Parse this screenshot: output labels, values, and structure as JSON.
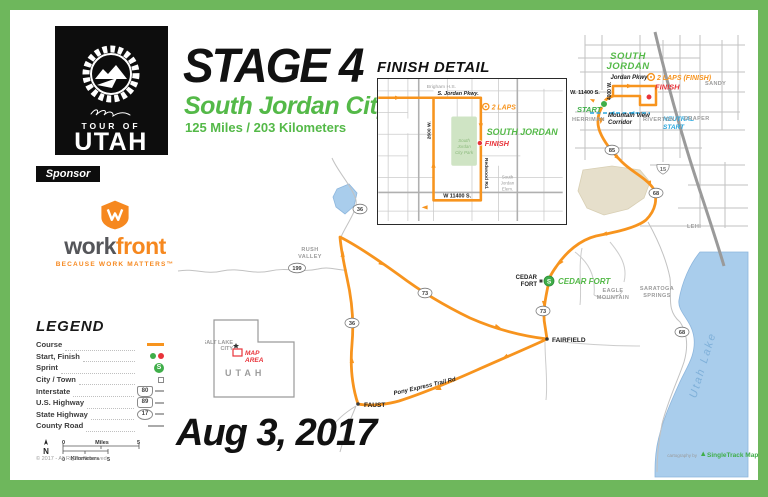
{
  "colors": {
    "frame_green": "#6eb75c",
    "accent_green": "#54b948",
    "route_orange": "#f7941e",
    "finish_red": "#e8333a",
    "neutral_blue": "#2aa7de",
    "sprint_green": "#3fae49",
    "workfront_orange": "#f6881f",
    "workfront_gray": "#55565a",
    "lake_blue": "#a9cdec",
    "road_gray": "#b5b5b5"
  },
  "header": {
    "stage": "STAGE 4",
    "city": "South Jordan City",
    "distance": "125 Miles / 203 Kilometers"
  },
  "logo": {
    "tour_of": "TOUR OF",
    "utah": "UTAH"
  },
  "sponsor_label": "Sponsor",
  "workfront": {
    "word1": "work",
    "word2": "front",
    "tagline": "BECAUSE WORK MATTERS™"
  },
  "legend": {
    "title": "LEGEND",
    "items": [
      {
        "label": "Course"
      },
      {
        "label": "Start, Finish"
      },
      {
        "label": "Sprint",
        "symbol_letter": "S"
      },
      {
        "label": "City / Town"
      },
      {
        "label": "Interstate",
        "shield": "80"
      },
      {
        "label": "U.S. Highway",
        "shield": "89"
      },
      {
        "label": "State Highway",
        "shield": "17"
      },
      {
        "label": "County Road"
      }
    ],
    "scale": {
      "north": "N",
      "zero": "0",
      "five": "5",
      "miles": "Miles",
      "kilometers": "Kilometers"
    },
    "copyright": "© 2017 - All Rights Reserved"
  },
  "state_inset": {
    "city_line1": "SALT LAKE",
    "city_line2": "CITY",
    "map_area_line1": "MAP",
    "map_area_line2": "AREA",
    "state": "UTAH"
  },
  "date": "Aug 3, 2017",
  "finish_detail": {
    "title": "FINISH DETAIL",
    "labels": {
      "school": "Brigham H.S.",
      "parkway": "S. Jordan Pkwy.",
      "laps": "2 LAPS",
      "city": "SOUTH JORDAN",
      "finish": "FINISH",
      "park": [
        "South",
        "Jordan",
        "City Park"
      ],
      "redwood": "Redwood Rd.",
      "elementary": [
        "South",
        "Jordan",
        "Elem."
      ],
      "south_street": "W 11400 S.",
      "west_street": "2600 W."
    }
  },
  "map": {
    "labels": {
      "south_jordan": [
        "SOUTH",
        "JORDAN"
      ],
      "laps_finish": "2 LAPS (FINISH)",
      "finish": "FINISH",
      "start": "START",
      "neutral_start": [
        "NEUTRAL",
        "START"
      ],
      "jordan_pkwy": "Jordan Pkwy",
      "w_11400_s": "W. 11400 S.",
      "street_4000w": "4000 W.",
      "mountain_view": [
        "Mountain View",
        "Corridor"
      ],
      "herriman": "HERRIMAN",
      "riverton": "RIVERTON",
      "sandy": "SANDY",
      "draper": "DRAPER",
      "lehi": "LEHI",
      "eagle_mountain": [
        "EAGLE",
        "MOUNTAIN"
      ],
      "saratoga_springs": [
        "SARATOGA",
        "SPRINGS"
      ],
      "rush_valley": [
        "RUSH",
        "VALLEY"
      ],
      "cedar_fort_town": [
        "CEDAR",
        "FORT"
      ],
      "cedar_fort_sprint": "CEDAR FORT",
      "fairfield": "FAIRFIELD",
      "faust": "FAUST",
      "pony_express": "Pony Express Trail Rd",
      "utah_lake": "Utah Lake"
    },
    "sprint_letter": "S",
    "shields": {
      "interstate_15": "15",
      "route_85": "85",
      "route_68_north": "68",
      "route_68_lake": "68",
      "route_73_pass": "73",
      "route_73_cedar": "73",
      "route_36_course": "36",
      "route_36_north": "36",
      "route_199": "199"
    },
    "credit": {
      "prefix": "cartography by",
      "name": "SingleTrack Maps"
    }
  }
}
